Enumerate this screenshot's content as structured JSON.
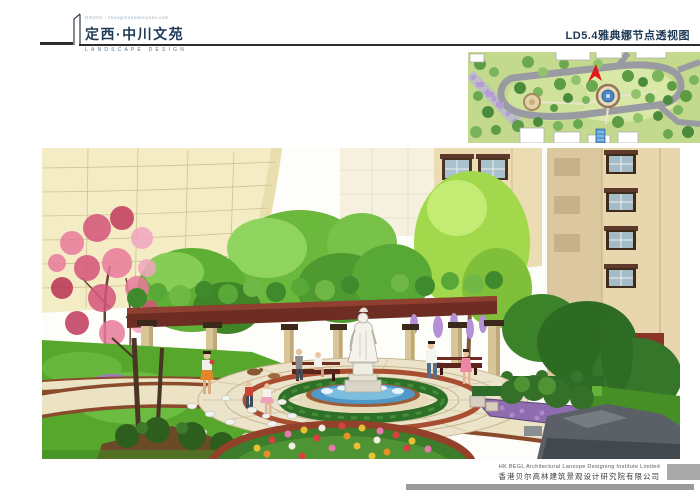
{
  "header": {
    "logo_tagline": "DINGXI · zhongchuanwenyuan.com",
    "project_title": "定西·中川文苑",
    "logo_subtitle": "LANDSCAPE DESIGN",
    "sheet_title": "LD5.4雅典娜节点透视图"
  },
  "footer": {
    "company_en": "HK BEGL Architectural Lansope Designing Institute Limited",
    "company_cn": "香港贝尔高林建筑景观设计研究院有限公司"
  },
  "inset": {
    "description": "master-plan-thumbnail",
    "marker_color": "#e01818"
  },
  "rendering": {
    "description": "athena-node-perspective-rendering"
  },
  "colors": {
    "accent_navy": "#1e3a56",
    "rule_dark": "#2c2c2c",
    "footer_gray": "#9b9b9b"
  }
}
